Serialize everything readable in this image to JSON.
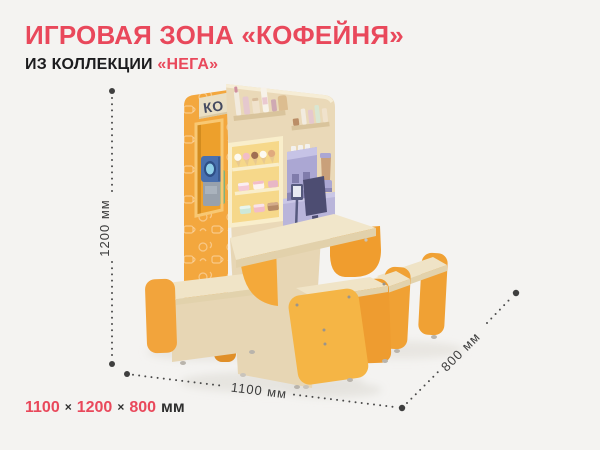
{
  "page": {
    "background_color": "#f4f3f1"
  },
  "header": {
    "title": "ИГРОВАЯ ЗОНА «КОФЕЙНЯ»",
    "subtitle_prefix": "ИЗ КОЛЛЕКЦИИ ",
    "subtitle_accent": "«НЕГА»",
    "accent_color": "#e9485b",
    "text_color": "#1c1c1e"
  },
  "product": {
    "sign_text": "КО",
    "colors": {
      "orange_wall": "#f3a73e",
      "orange_deep": "#ef9d30",
      "front_yellow": "#f5b545",
      "wood": "#ead9b8",
      "wood_light": "#f1e6ca",
      "case_cream": "#f9eecb",
      "case_yellow": "#f6d88a",
      "appliance_lilac": "#aba7d3",
      "monitor_navy": "#4d4d72",
      "toy_blue": "#4a70ae"
    }
  },
  "dimensions": {
    "height_label": "1200 мм",
    "width_label": "1100 мм",
    "depth_label": "800 мм",
    "line_color": "#4a4a4a",
    "label_color": "#3c3c3c"
  },
  "footer": {
    "width_value": "1100",
    "height_value": "1200",
    "depth_value": "800",
    "separator": "×",
    "unit": "мм"
  }
}
